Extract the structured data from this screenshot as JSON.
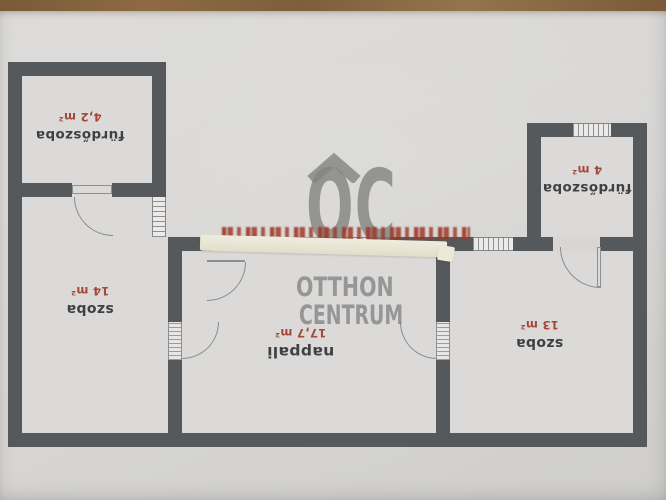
{
  "plan": {
    "rooms": [
      {
        "name": "fürdőszoba",
        "area": "4,2 m²"
      },
      {
        "name": "szoba",
        "area": "14 m²"
      },
      {
        "name": "nappali",
        "area": "17,7 m²"
      },
      {
        "name": "szoba",
        "area": "13 m²"
      },
      {
        "name": "fürdőszoba",
        "area": "4 m²"
      }
    ]
  },
  "watermark": {
    "monogram": "OC",
    "line1": "OTTHON",
    "line2": "CENTRUM"
  },
  "colors": {
    "wall": "#55595b",
    "paper": "#d7d6d4",
    "area_red": "#a3493a",
    "label_dark": "#3e4143",
    "watermark_gray": "#828381",
    "tape": "#ebe7d8",
    "wood": "#855f3a"
  }
}
